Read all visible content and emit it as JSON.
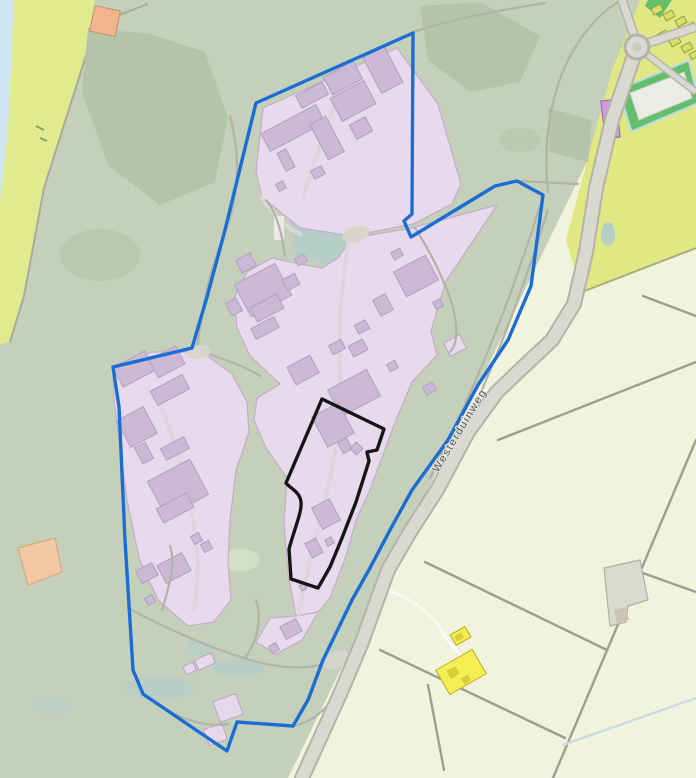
{
  "map": {
    "road_label": "Westerduinweg",
    "features": {
      "site_boundary": "blue site boundary outline",
      "selected_parcel": "black selected parcel outline",
      "campus": "pink industrial / institutional campus zones",
      "greenspace": "dune greenspace",
      "farmland": "farm parcels east of road",
      "water": "water strip north-west"
    },
    "colors": {
      "greenspace": "#c5d0ba",
      "dark_green": "#b3c4a9",
      "pond_teal": "#b5cec8",
      "water": "#cfe6f2",
      "dune_grass": "#e0ea8e",
      "farmland_light": "#f2f3dd",
      "farmland_yellow": "#dfe882",
      "campus_pink": "#e9d9ec",
      "building_purple": "#cbb9d6",
      "boundary_blue": "#1a6dd5",
      "parcel_black": "#161616",
      "road_fill": "#d9d9d1",
      "road_casing": "#b3b3a9",
      "greenhouse_green": "#63bf6c",
      "greenhouse_white": "#ecece7",
      "yellow_building": "#f4ef55",
      "purple_building": "#cf9bdd",
      "salmon_building": "#f2b68f",
      "peach_parcel": "#f3c8a4"
    },
    "building_groups": [
      {
        "name": "campus-buildings",
        "fill": "#cbb9d6",
        "stroke": "#b1a0bf",
        "rects": [
          [
            326,
            68,
            34,
            20,
            -28
          ],
          [
            371,
            50,
            24,
            40,
            -28
          ],
          [
            297,
            88,
            30,
            14,
            -28
          ],
          [
            334,
            88,
            38,
            26,
            -28
          ],
          [
            262,
            118,
            62,
            20,
            -28
          ],
          [
            318,
            118,
            18,
            40,
            -28
          ],
          [
            352,
            120,
            18,
            16,
            -28
          ],
          [
            281,
            150,
            10,
            20,
            -28
          ],
          [
            312,
            168,
            12,
            9,
            -28
          ],
          [
            277,
            182,
            8,
            8,
            -28
          ],
          [
            240,
            272,
            46,
            36,
            -28
          ],
          [
            252,
            300,
            30,
            16,
            -28
          ],
          [
            238,
            256,
            16,
            14,
            -28
          ],
          [
            284,
            276,
            14,
            12,
            -28
          ],
          [
            228,
            300,
            12,
            14,
            -28
          ],
          [
            252,
            322,
            26,
            12,
            -28
          ],
          [
            296,
            256,
            10,
            8,
            -28
          ],
          [
            398,
            262,
            36,
            28,
            -28
          ],
          [
            376,
            296,
            14,
            18,
            -28
          ],
          [
            356,
            322,
            12,
            10,
            -28
          ],
          [
            350,
            342,
            16,
            12,
            -28
          ],
          [
            392,
            250,
            10,
            8,
            -28
          ],
          [
            434,
            300,
            8,
            8,
            -28
          ],
          [
            332,
            378,
            44,
            30,
            -28
          ],
          [
            290,
            360,
            26,
            20,
            -28
          ],
          [
            330,
            342,
            14,
            10,
            -28
          ],
          [
            388,
            362,
            9,
            8,
            -28
          ],
          [
            424,
            384,
            11,
            9,
            -28
          ],
          [
            318,
            408,
            30,
            34,
            -28
          ],
          [
            340,
            440,
            10,
            12,
            -28
          ],
          [
            352,
            444,
            9,
            9,
            -45
          ],
          [
            316,
            502,
            20,
            24,
            -28
          ],
          [
            308,
            540,
            12,
            16,
            -28
          ],
          [
            326,
            538,
            7,
            7,
            -28
          ],
          [
            300,
            584,
            6,
            6,
            -28
          ],
          [
            116,
            358,
            36,
            22,
            -28
          ],
          [
            152,
            352,
            30,
            20,
            -28
          ],
          [
            152,
            382,
            36,
            16,
            -28
          ],
          [
            122,
            412,
            30,
            30,
            -28
          ],
          [
            138,
            444,
            12,
            18,
            -28
          ],
          [
            162,
            442,
            26,
            13,
            -28
          ],
          [
            154,
            468,
            48,
            40,
            -28
          ],
          [
            158,
            500,
            34,
            16,
            -28
          ],
          [
            192,
            534,
            9,
            9,
            -28
          ],
          [
            202,
            542,
            9,
            9,
            -28
          ],
          [
            138,
            566,
            18,
            14,
            -28
          ],
          [
            160,
            558,
            28,
            20,
            -28
          ],
          [
            146,
            596,
            8,
            8,
            -28
          ],
          [
            282,
            622,
            18,
            14,
            -28
          ],
          [
            270,
            644,
            8,
            8,
            -28
          ],
          [
            224,
            704,
            9,
            9,
            -20
          ],
          [
            212,
            732,
            6,
            6,
            -20
          ],
          [
            452,
            344,
            7,
            7,
            -28
          ]
        ]
      },
      {
        "name": "pink-pavilions",
        "fill": "#e8d8eb",
        "stroke": "#b9a6c4",
        "rects": [
          [
            216,
            697,
            24,
            22,
            -20
          ],
          [
            206,
            726,
            19,
            17,
            -20
          ],
          [
            196,
            656,
            18,
            11,
            -25
          ],
          [
            184,
            664,
            11,
            9,
            -25
          ],
          [
            446,
            338,
            18,
            15,
            -28
          ]
        ]
      },
      {
        "name": "village-houses",
        "fill": "#d7de6b",
        "stroke": "#97a040",
        "rects": [
          [
            652,
            6,
            10,
            7,
            -28
          ],
          [
            664,
            12,
            10,
            7,
            -28
          ],
          [
            676,
            18,
            10,
            7,
            -28
          ],
          [
            686,
            24,
            10,
            7,
            -28
          ],
          [
            658,
            32,
            10,
            7,
            -28
          ],
          [
            670,
            38,
            10,
            7,
            -28
          ],
          [
            682,
            44,
            10,
            7,
            -28
          ],
          [
            690,
            52,
            8,
            6,
            -28
          ]
        ]
      },
      {
        "name": "yellow-farm-buildings",
        "fill": "#f4ef55",
        "stroke": "#b5ab17",
        "rects": [
          [
            452,
            630,
            17,
            12,
            -30
          ],
          [
            440,
            658,
            42,
            28,
            -30
          ]
        ]
      },
      {
        "name": "yellow-building-marks",
        "fill": "#d9ce3a",
        "stroke": "none",
        "rects": [
          [
            448,
            668,
            10,
            9,
            -30
          ],
          [
            462,
            676,
            8,
            7,
            -30
          ],
          [
            455,
            634,
            8,
            6,
            -30
          ]
        ]
      },
      {
        "name": "purple-building",
        "fill": "#cf9bdd",
        "stroke": "#9e5bb5",
        "rects": [
          [
            603,
            100,
            15,
            38,
            -7
          ]
        ]
      },
      {
        "name": "salmon-building",
        "fill": "#f2b68f",
        "stroke": "#cc8a63",
        "rects": [
          [
            92,
            8,
            26,
            26,
            12
          ]
        ]
      }
    ]
  }
}
